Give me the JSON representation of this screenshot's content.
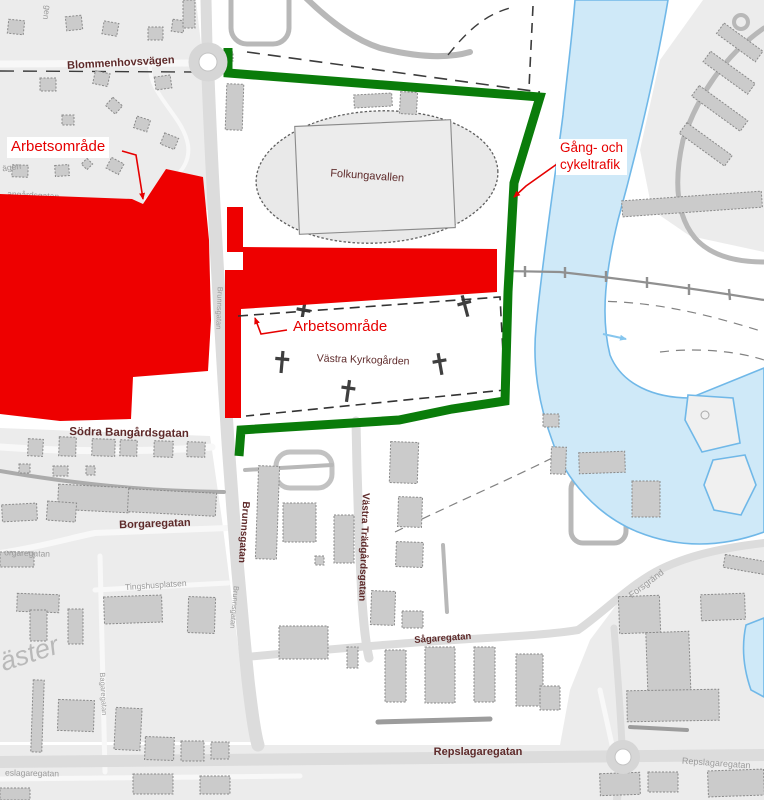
{
  "map": {
    "annotations": [
      {
        "id": "arbetsomrade-west",
        "text": "Arbetsområde",
        "x": 7,
        "y": 137,
        "size": 15
      },
      {
        "id": "arbetsomrade-east",
        "text": "Arbetsområde",
        "x": 289,
        "y": 317,
        "size": 15
      },
      {
        "id": "gang-och-cykeltrafik",
        "text": "Gång- och\ncykeltrafik",
        "x": 556,
        "y": 139,
        "size": 13.5
      }
    ],
    "street_labels": [
      {
        "id": "blommenhovsvagen",
        "text": "Blommenhovsvägen",
        "x": 121,
        "y": 66,
        "rot": -3,
        "size": 11,
        "cls": "lbl-maroon",
        "bold": true
      },
      {
        "id": "folkungavallen",
        "text": "Folkungavallen",
        "x": 367,
        "y": 179,
        "rot": 4,
        "size": 11,
        "cls": "lbl-maroon",
        "bold": false
      },
      {
        "id": "vastra-kyrkogarden",
        "text": "Västra Kyrkogården",
        "x": 363,
        "y": 363,
        "rot": 2,
        "size": 10.5,
        "cls": "lbl-maroon",
        "bold": false
      },
      {
        "id": "sodra-bangardsgatan",
        "text": "Södra Bangårdsgatan",
        "x": 129,
        "y": 436,
        "rot": 1,
        "size": 11.5,
        "cls": "lbl-maroon",
        "bold": true
      },
      {
        "id": "borgaregatan",
        "text": "Borgaregatan",
        "x": 155,
        "y": 527,
        "rot": -2,
        "size": 11,
        "cls": "lbl-maroon",
        "bold": true
      },
      {
        "id": "brunnsgatan",
        "text": "Brunnsgatan",
        "x": 241,
        "y": 532,
        "rot": 94,
        "size": 10,
        "cls": "lbl-maroon",
        "bold": true
      },
      {
        "id": "vastra-tradgardsgatan",
        "text": "Västra Trädgårdsgatan",
        "x": 361,
        "y": 547,
        "rot": 92,
        "size": 10,
        "cls": "lbl-maroon",
        "bold": true
      },
      {
        "id": "sagaregatan",
        "text": "Sågaregatan",
        "x": 443,
        "y": 641,
        "rot": -4,
        "size": 9.5,
        "cls": "lbl-maroon",
        "bold": true
      },
      {
        "id": "repslagaregatan",
        "text": "Repslagaregatan",
        "x": 478,
        "y": 755,
        "rot": 0,
        "size": 11,
        "cls": "lbl-maroon",
        "bold": true
      },
      {
        "id": "repslagaregatan-2",
        "text": "Repslagaregatan",
        "x": 716,
        "y": 766,
        "rot": 4,
        "size": 9,
        "cls": "lbl-gray",
        "bold": false
      },
      {
        "id": "forsgrand",
        "text": "Forsgränd",
        "x": 648,
        "y": 586,
        "rot": -37,
        "size": 9,
        "cls": "lbl-gray",
        "bold": false
      },
      {
        "id": "tingshusplatsen",
        "text": "Tingshusplatsen",
        "x": 156,
        "y": 588,
        "rot": -4,
        "size": 8.5,
        "cls": "lbl-gray",
        "bold": false
      },
      {
        "id": "borgaregatan-fragment",
        "text": "orgaregatan",
        "x": 27,
        "y": 556,
        "rot": 2,
        "size": 8.5,
        "cls": "lbl-gray",
        "bold": false
      },
      {
        "id": "repslagaregatan-fragment",
        "text": "eslagaregatan",
        "x": 32,
        "y": 776,
        "rot": 1,
        "size": 8.5,
        "cls": "lbl-gray",
        "bold": false
      },
      {
        "id": "bagaregatan",
        "text": "Bagaregatan",
        "x": 101,
        "y": 694,
        "rot": 87,
        "size": 7.5,
        "cls": "lbl-gray",
        "bold": false
      },
      {
        "id": "brunnsgatan-gray-1",
        "text": "Brunnsgatan",
        "x": 217,
        "y": 308,
        "rot": 92,
        "size": 7.5,
        "cls": "lbl-gray",
        "bold": false
      },
      {
        "id": "brunnsgatan-gray-2",
        "text": "Brunnsgatan",
        "x": 232,
        "y": 607,
        "rot": 95,
        "size": 7.5,
        "cls": "lbl-gray",
        "bold": false
      },
      {
        "id": "bangardsgatan-fragment",
        "text": "angårdsgatan",
        "x": 33,
        "y": 198,
        "rot": 3,
        "size": 8.5,
        "cls": "lbl-gray",
        "bold": false
      },
      {
        "id": "vagen-fragment",
        "text": "ägen",
        "x": 12,
        "y": 170,
        "rot": -8,
        "size": 8.5,
        "cls": "lbl-gray",
        "bold": false
      },
      {
        "id": "gen-fragment",
        "text": "gen",
        "x": 44,
        "y": 12,
        "rot": 100,
        "size": 8.5,
        "cls": "lbl-gray",
        "bold": false
      },
      {
        "id": "vaster-district",
        "text": "äster",
        "x": 32,
        "y": 662,
        "rot": -18,
        "size": 27,
        "cls": "lbl-big",
        "bold": false
      }
    ],
    "colors": {
      "work_area_red": "#ee0000",
      "annotation_red_text": "#e60000",
      "route_green": "#0a7c0a",
      "street_label_maroon": "#5e2a2a",
      "faded_label_gray": "#9a9a9a",
      "water_fill": "#cfe9f8",
      "water_stroke": "#70b8e8"
    }
  }
}
